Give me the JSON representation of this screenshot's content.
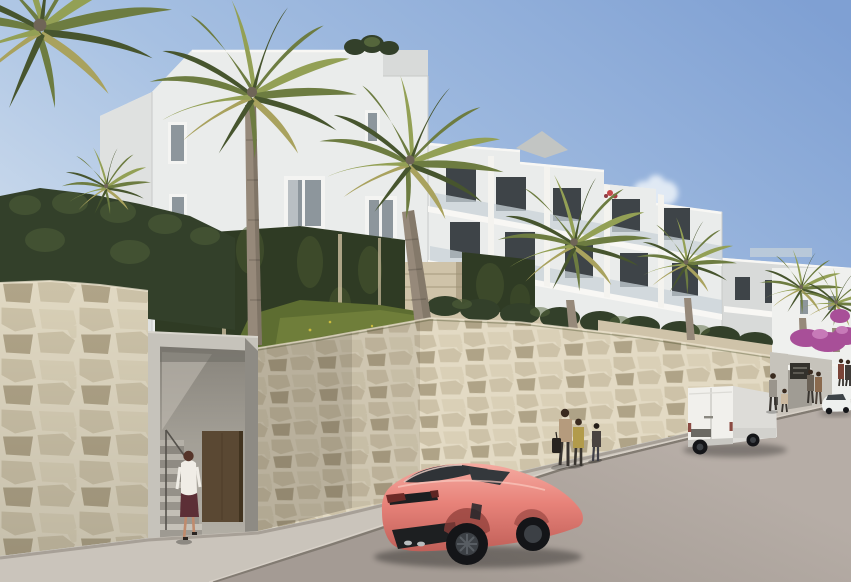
{
  "scene": {
    "objects": [
      "apartment-building",
      "palm-trees",
      "left-hedge",
      "ivy-green-wall",
      "grass-slope",
      "stone-retaining-wall",
      "pedestrian-entrance",
      "entrance-staircase",
      "brown-entry-door",
      "sidewalk",
      "street",
      "curb",
      "coral-sports-car",
      "white-cargo-van",
      "white-sedan",
      "gate-with-sign",
      "bougainvillea",
      "cloud",
      "pedestrians",
      "shade-sail",
      "roof-plants"
    ],
    "pedestrian_groups": [
      {
        "name": "woman-entering-stairs",
        "count": 1
      },
      {
        "name": "family-by-wall",
        "count": 3
      },
      {
        "name": "adult-and-child-by-van",
        "count": 2
      },
      {
        "name": "people-at-gate",
        "count": 2
      },
      {
        "name": "pair-far-right",
        "count": 2
      }
    ],
    "vehicles": [
      {
        "name": "sports-car",
        "color_name": "coral"
      },
      {
        "name": "cargo-van",
        "color_name": "white"
      },
      {
        "name": "sedan",
        "color_name": "white"
      }
    ]
  },
  "colors": {
    "sky_top": "#7fa0d3",
    "sky_mid": "#a6c0e2",
    "sky_low": "#d6e2ef",
    "cloud": "#edf3f9",
    "bldg_lit": "#f4f3ef",
    "bldg_face": "#eaeceb",
    "bldg_side": "#dfe1e0",
    "bldg_recess": "#d8dad9",
    "bldg_line": "#c7c9c8",
    "parapet": "#f8f7f4",
    "win_dark": "#3e4448",
    "win_glass": "#8d969c",
    "win_frame": "#f4f4f2",
    "rail_glass": "#c9d3d8",
    "sail": "#c2c5c3",
    "ivy": "#2f3b24",
    "ivy_light": "#49582f",
    "hedge": "#33402a",
    "hedge_light": "#55663c",
    "grass": "#5d6d31",
    "grass_light": "#7d8c42",
    "flower": "#d6c23e",
    "palm_a": "#6d7c41",
    "palm_b": "#47552e",
    "palm_c": "#93a055",
    "palm_d": "#a9a25e",
    "trunk": "#96897a",
    "trunk_dark": "#6f6557",
    "stone": "#cdc2a8",
    "stone_l": "#ded4bc",
    "stone_d": "#a79a7e",
    "mortar": "#e9e1cc",
    "wall_shadow": "#4a4436",
    "concrete": "#c6c3bb",
    "concrete_mid": "#a09c94",
    "concrete_dark": "#8e8b84",
    "interior": "#9b978f",
    "door": "#5a4833",
    "door_dark": "#41331f",
    "sidewalk": "#cac4bb",
    "road": "#b6ada6",
    "road_dark": "#a49b94",
    "curb": "#827b72",
    "curb_light": "#d9d3ca",
    "car_red": "#e8837a",
    "car_red_l": "#f5aca2",
    "car_red_d": "#c05f58",
    "car_red_deep": "#96423e",
    "car_trim": "#1d1f21",
    "car_glass": "#2f3337",
    "tail_red": "#6e2a27",
    "wheel": "#141518",
    "rim": "#3c4045",
    "van_white": "#f1f0ec",
    "van_side": "#dddcd8",
    "van_dark": "#6b6963",
    "sedan_white": "#eef0ee",
    "terrace_wall": "#cfc3a9",
    "bougain": "#a84f98",
    "bougain_l": "#c77ab8",
    "sign": "#33312c",
    "white_bg": "#eff0ee",
    "skin": "#c08b6d",
    "hair": "#3a2b20",
    "shirt": "#f0ede6",
    "skirt": "#5c2f36",
    "bag": "#27231f",
    "mom_top": "#b59b7d",
    "child_jacket": "#b29b4b",
    "pants": "#38342f",
    "gray_top": "#9a958c",
    "shadow": "#2a2620"
  }
}
